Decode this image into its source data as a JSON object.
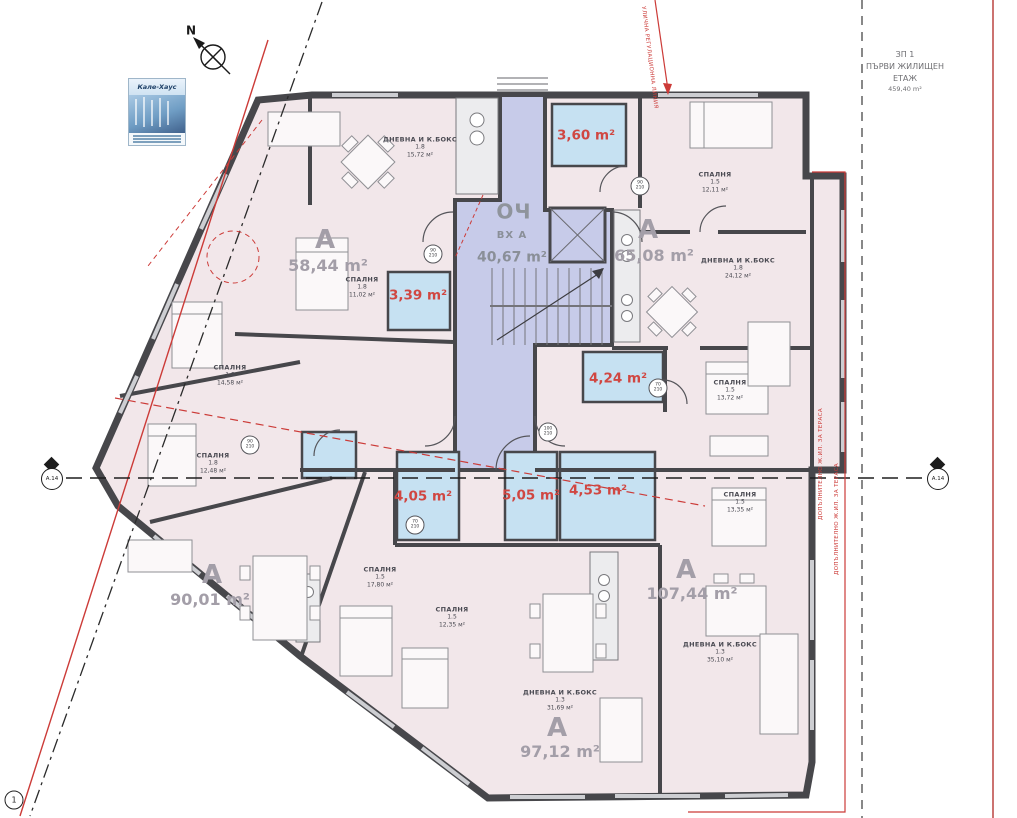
{
  "site_note": {
    "code": "ЗП 1",
    "title_line1": "ПЪРВИ ЖИЛИЩЕН",
    "title_line2": "ЕТАЖ",
    "area": "459,40 m²"
  },
  "north": {
    "label": "N"
  },
  "logo": {
    "title": "Кале-Хаус"
  },
  "entrance_hall": {
    "code": "ОЧ",
    "entrance": "ВХ А",
    "area": "40,67 m²"
  },
  "apartments": [
    {
      "letter": "А",
      "area": "58,44 m²"
    },
    {
      "letter": "А",
      "area": "65,08 m²"
    },
    {
      "letter": "А",
      "area": "90,01 m²"
    },
    {
      "letter": "А",
      "area": "97,12 m²"
    },
    {
      "letter": "А",
      "area": "107,44 m²"
    }
  ],
  "rooms": [
    {
      "name": "ДНЕВНА И К.БОКС",
      "ratio": "1.8",
      "area": "15,72 м²"
    },
    {
      "name": "СПАЛНЯ",
      "ratio": "1.8",
      "area": "11,02 м²"
    },
    {
      "name": "СПАЛНЯ",
      "ratio": "1.5",
      "area": "12,11 м²"
    },
    {
      "name": "ДНЕВНА И К.БОКС",
      "ratio": "1.8",
      "area": "24,12 м²"
    },
    {
      "name": "СПАЛНЯ",
      "ratio": "1.8",
      "area": "14,58 м²"
    },
    {
      "name": "СПАЛНЯ",
      "ratio": "1.8",
      "area": "12,48 м²"
    },
    {
      "name": "СПАЛНЯ",
      "ratio": "1.5",
      "area": "13,72 м²"
    },
    {
      "name": "СПАЛНЯ",
      "ratio": "1.5",
      "area": "13,35 м²"
    },
    {
      "name": "СПАЛНЯ",
      "ratio": "1.5",
      "area": "17,80 м²"
    },
    {
      "name": "СПАЛНЯ",
      "ratio": "1.5",
      "area": "12,35 м²"
    },
    {
      "name": "ДНЕВНА И К.БОКС",
      "ratio": "1.3",
      "area": "31,69 м²"
    },
    {
      "name": "ДНЕВНА И К.БОКС",
      "ratio": "1.3",
      "area": "35,10 м²"
    }
  ],
  "bathroom_areas": [
    "3,60 m²",
    "3,39 m²",
    "4,24 m²",
    "4,05 m²",
    "5,05 m²",
    "4,53 m²"
  ],
  "door_markers": [
    {
      "w": "90",
      "h": "210"
    },
    {
      "w": "90",
      "h": "210"
    },
    {
      "w": "70",
      "h": "210"
    },
    {
      "w": "90",
      "h": "210"
    },
    {
      "w": "70",
      "h": "210"
    },
    {
      "w": "100",
      "h": "210"
    }
  ],
  "section_markers": {
    "left": "А.14",
    "right": "А.14"
  },
  "corner_marker": "1",
  "red_notes": {
    "top": "УЛИЧНА РЕГУЛАЦИОННА ЛИНИЯ",
    "right_inner": "ДОПЪЛНИТЕЛНО Ж.ИЛ. ЗА ТЕРАСА",
    "right_outer": "ДОПЪЛНИТЕЛНО Ж.ИЛ. ЗА ТЕРАСА"
  },
  "colors": {
    "wall": "#47474b",
    "room_fill": "#f2e7ea",
    "corridor_fill": "#c7cbe9",
    "bath_fill": "#c6e1f2",
    "red": "#cc3b38",
    "gray_text": "#a39ea8"
  }
}
